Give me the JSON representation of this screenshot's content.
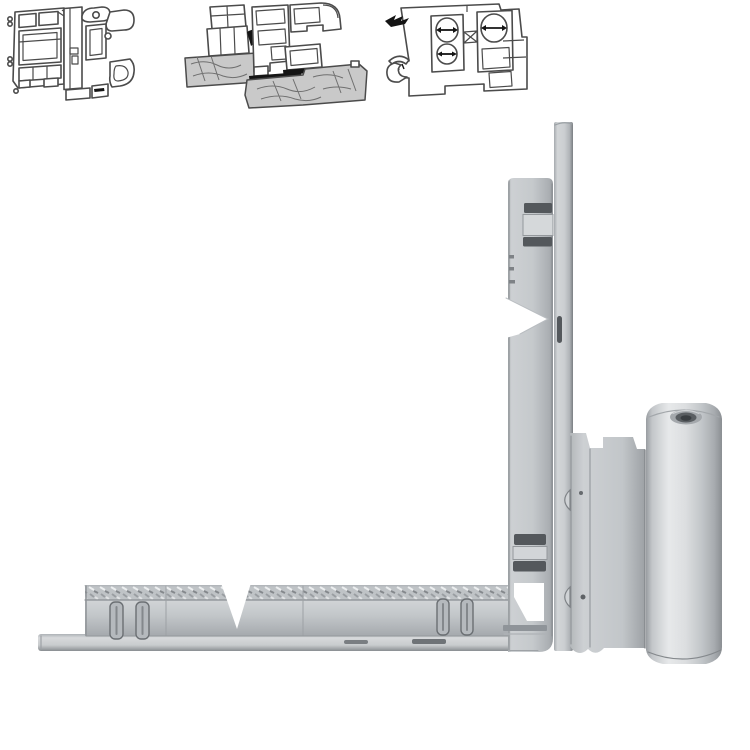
{
  "canvas": {
    "width": 750,
    "height": 750,
    "background": "#ffffff"
  },
  "palette": {
    "diagram_line": "#4b4b4b",
    "wood_fill": "#c9c9c9",
    "seal_black": "#141414",
    "profile_fill": "#ffffff",
    "metal_base": "#c3c7ca",
    "metal_highlight": "#e9ebec",
    "metal_shadow": "#8e9296",
    "slot_dark": "#54585c"
  },
  "figures": {
    "thumbnails": [
      {
        "name": "pvc-window-profile-cross-section"
      },
      {
        "name": "timber-window-profile-cross-section"
      },
      {
        "name": "aluminium-thermal-break-profile-cross-section"
      }
    ],
    "product": {
      "name": "window-corner-hinge-assembly",
      "parts": [
        "vertical-guide-rail",
        "vertical-faceplate",
        "corner-junction",
        "horizontal-faceplate",
        "horizontal-guide-rail",
        "hinge-side-plate",
        "hinge-barrel",
        "hinge-pin-bore"
      ]
    }
  }
}
